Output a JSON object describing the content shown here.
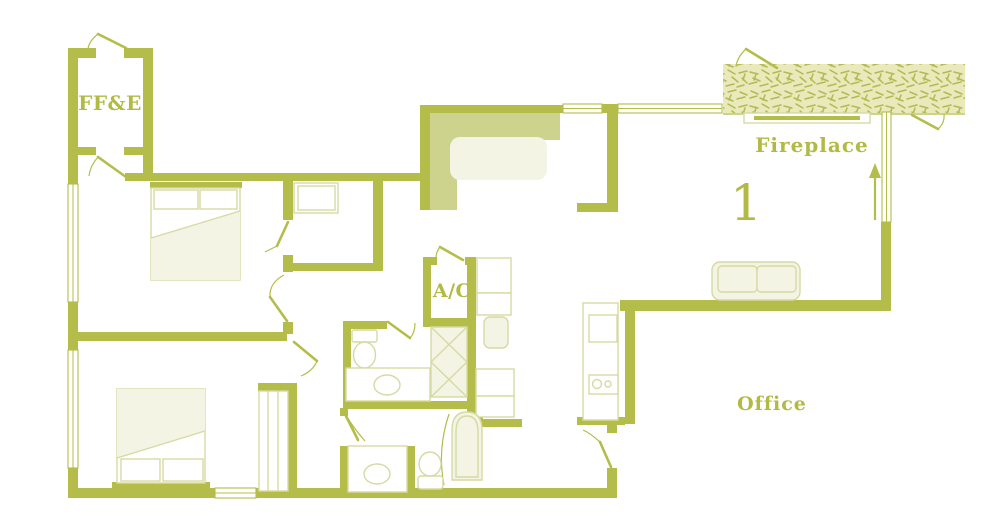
{
  "plan": {
    "unit_number": "1",
    "labels": {
      "storage": "FF&E",
      "fireplace": "Fireplace",
      "ac": "A/C",
      "office": "Office"
    },
    "colors": {
      "background": "#ffffff",
      "wall": "#b5bd4a",
      "counter": "#cdd28d",
      "furniture_fill": "#f3f4e4",
      "furniture_outline": "#d6daa2",
      "deck_fill": "#e9e9bb",
      "deck_hatch": "#b2ba52",
      "label_text": "#b2ba43"
    }
  }
}
